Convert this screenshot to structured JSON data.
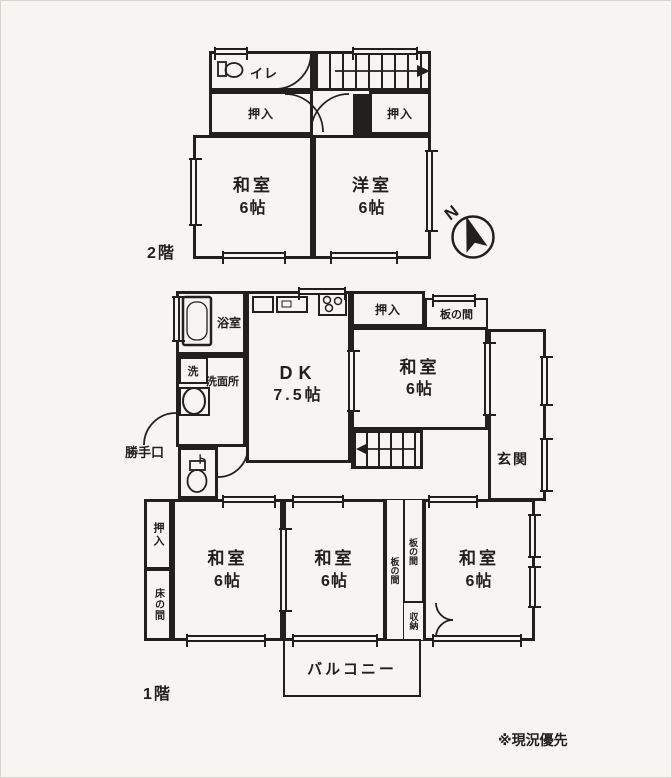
{
  "doc": {
    "floor2_label": "2階",
    "floor1_label": "1階",
    "note": "※現況優先",
    "compass": "N"
  },
  "colors": {
    "paper": "#f6f5f2",
    "ink": "#21201d"
  },
  "floor2": {
    "toilet_label": "イレ",
    "oshiire_left": "押入",
    "oshiire_right": "押入",
    "washitsu": {
      "name": "和室",
      "size": "6帖"
    },
    "yoshitsu": {
      "name": "洋室",
      "size": "6帖"
    }
  },
  "floor1": {
    "bathroom": "浴室",
    "laundry": "洗",
    "washroom": "洗面所",
    "back_door": "勝手口",
    "toilet": "ト",
    "dk": {
      "name": "DK",
      "size": "7.5帖"
    },
    "oshiire_top": "押入",
    "itanoma_top": "板の間",
    "washitsu_ne": {
      "name": "和室",
      "size": "6帖"
    },
    "genkan": "玄関",
    "oshiire_sw": "押入",
    "tokonoma": "床の間",
    "washitsu_sw": {
      "name": "和室",
      "size": "6帖"
    },
    "washitsu_s": {
      "name": "和室",
      "size": "6帖"
    },
    "itanoma_s1": "板の間",
    "itanoma_s2": "板の間",
    "shuunou": "収納",
    "washitsu_se": {
      "name": "和室",
      "size": "6帖"
    },
    "balcony": "バルコニー"
  }
}
